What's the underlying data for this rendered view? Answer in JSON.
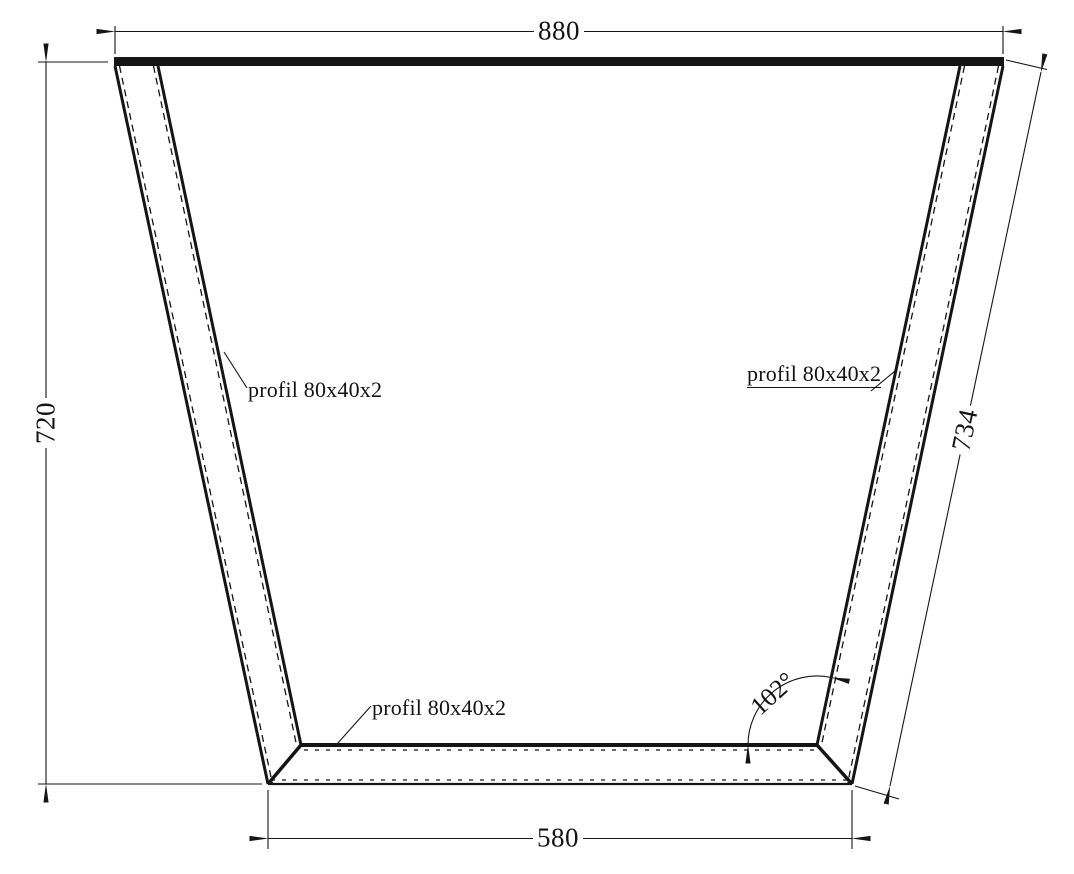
{
  "dimensions": {
    "top_width": "880",
    "left_height": "720",
    "right_side_length": "734",
    "bottom_width": "580",
    "corner_angle": "102°"
  },
  "labels": {
    "left_profile": "profil 80x40x2",
    "right_profile": "profil 80x40x2",
    "bottom_profile": "profil 80x40x2"
  },
  "colors": {
    "line_color": "#151515",
    "background": "#ffffff"
  }
}
